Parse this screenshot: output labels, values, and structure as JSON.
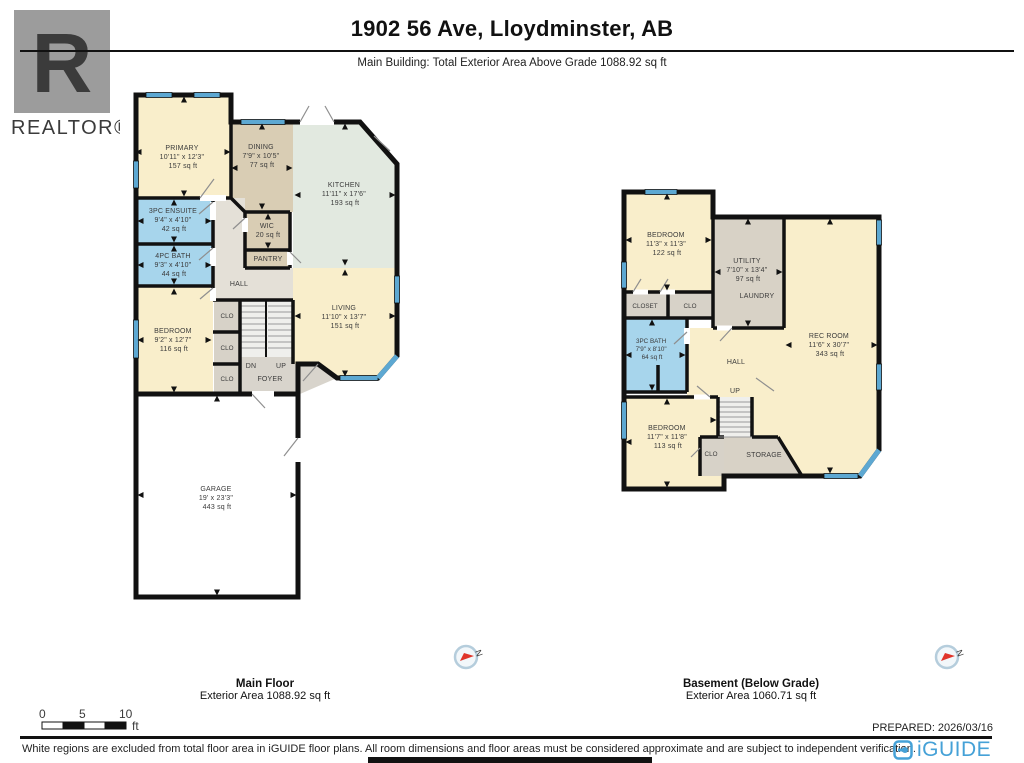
{
  "header": {
    "title": "1902 56 Ave, Lloydminster, AB",
    "subtitle": "Main Building: Total Exterior Area Above Grade 1088.92 sq ft",
    "realtor_logo_letter": "R",
    "realtor_logo_text": "REALTOR®"
  },
  "main_floor": {
    "caption": "Main Floor",
    "area_caption": "Exterior Area 1088.92 sq ft",
    "rooms": {
      "primary": {
        "name": "PRIMARY",
        "dims": "10'11\" x 12'3\"",
        "area": "157 sq ft"
      },
      "dining": {
        "name": "DINING",
        "dims": "7'9\" x 10'5\"",
        "area": "77 sq ft"
      },
      "kitchen": {
        "name": "KITCHEN",
        "dims": "11'11\" x 17'6\"",
        "area": "193 sq ft"
      },
      "ensuite": {
        "name": "3PC ENSUITE",
        "dims": "9'4\" x 4'10\"",
        "area": "42 sq ft"
      },
      "bath": {
        "name": "4PC BATH",
        "dims": "9'3\" x 4'10\"",
        "area": "44 sq ft"
      },
      "wic": {
        "name": "WIC",
        "area": "20 sq ft"
      },
      "pantry": {
        "name": "PANTRY"
      },
      "hall": {
        "name": "HALL"
      },
      "bedroom": {
        "name": "BEDROOM",
        "dims": "9'2\" x 12'7\"",
        "area": "116 sq ft"
      },
      "living": {
        "name": "LIVING",
        "dims": "11'10\" x 13'7\"",
        "area": "151 sq ft"
      },
      "foyer": {
        "name": "FOYER"
      },
      "garage": {
        "name": "GARAGE",
        "dims": "19' x 23'3\"",
        "area": "443 sq ft"
      },
      "clo": {
        "name": "CLO"
      },
      "dn": {
        "name": "DN"
      },
      "up": {
        "name": "UP"
      }
    }
  },
  "basement": {
    "caption": "Basement (Below Grade)",
    "area_caption": "Exterior Area 1060.71 sq ft",
    "rooms": {
      "bedroom1": {
        "name": "BEDROOM",
        "dims": "11'3\" x 11'3\"",
        "area": "122 sq ft"
      },
      "utility": {
        "name": "UTILITY",
        "dims": "7'10\" x 13'4\"",
        "area": "97 sq ft"
      },
      "laundry": {
        "name": "LAUNDRY"
      },
      "closet": {
        "name": "CLOSET"
      },
      "clo": {
        "name": "CLO"
      },
      "bath": {
        "name": "3PC BATH",
        "dims": "7'9\" x 8'10\"",
        "area": "64 sq ft"
      },
      "rec": {
        "name": "REC ROOM",
        "dims": "11'6\" x 30'7\"",
        "area": "343 sq ft"
      },
      "hall": {
        "name": "HALL"
      },
      "up": {
        "name": "UP"
      },
      "bedroom2": {
        "name": "BEDROOM",
        "dims": "11'7\" x 11'8\"",
        "area": "113 sq ft"
      },
      "storage": {
        "name": "STORAGE"
      }
    }
  },
  "compass": {
    "label": "N"
  },
  "footer": {
    "scale": {
      "ticks": [
        "0",
        "5",
        "10"
      ],
      "unit": "ft"
    },
    "prepared": "PREPARED: 2026/03/16",
    "disclaimer": "White regions are excluded from total floor area in iGUIDE floor plans. All room dimensions and floor areas must be considered approximate and are subject to independent verification.",
    "brand": "iGUIDE"
  },
  "colors": {
    "room_cream": "#f9eecb",
    "room_tan": "#d9cdb4",
    "room_green": "#e2e9e0",
    "room_blue": "#a7d5ec",
    "hall_gray": "#e4e0d7",
    "foyer_gray": "#d8d4cc",
    "closet_gray": "#d7d2c8",
    "utility_gray": "#d8d2c6",
    "stairs": "#efefec",
    "wall": "#111111",
    "window": "#5da8d2",
    "brand_blue": "#45a1d7",
    "logo_gray": "#9c9c9c"
  }
}
